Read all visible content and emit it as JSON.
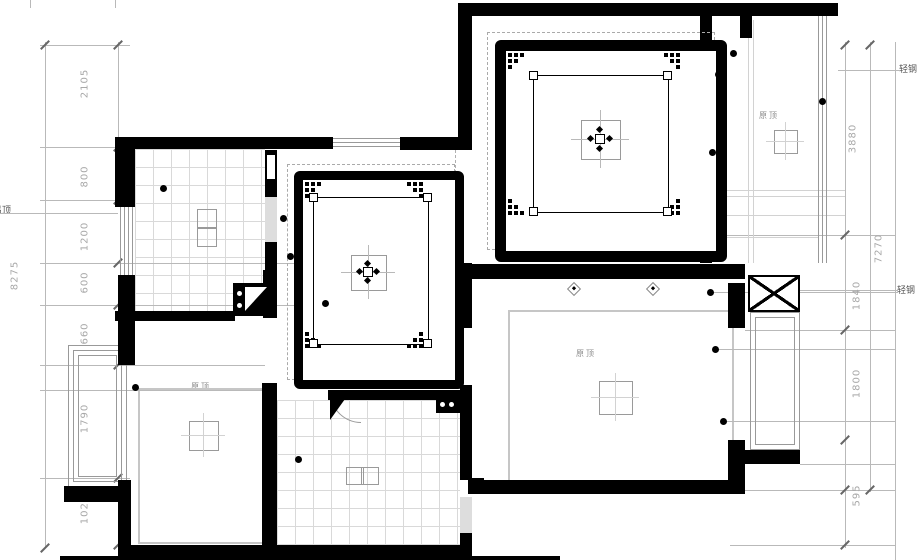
{
  "drawing": {
    "type": "residential ceiling plan (CAD)",
    "room_label": "原顶",
    "left_note": "吊顶",
    "right_note_top": "轻钢",
    "right_note_bottom": "轻钢"
  },
  "dimensions": {
    "left_total": "8275",
    "left_chain": [
      "2105",
      "800",
      "1200",
      "600",
      "660",
      "1790",
      "1020"
    ],
    "right_chain": [
      "3880",
      "7270",
      "1840",
      "1800",
      "595"
    ]
  },
  "colors": {
    "wall": "#000000",
    "dimension_text": "#a8a8a8",
    "tile_grid": "#d9d9d9",
    "ceiling_text": "#8c8c8c",
    "note_text": "#555555"
  },
  "icons": {
    "downlight": "downlight-dot-icon",
    "diamond_light": "diamond-light-icon",
    "ceiling_lamp": "ceiling-lamp-icon",
    "ornate_ceiling_lamp": "ornate-ceiling-lamp-icon",
    "vent_fixture": "vent-fixture-icon",
    "door": "door-icon",
    "shaft": "shaft-x-icon"
  }
}
